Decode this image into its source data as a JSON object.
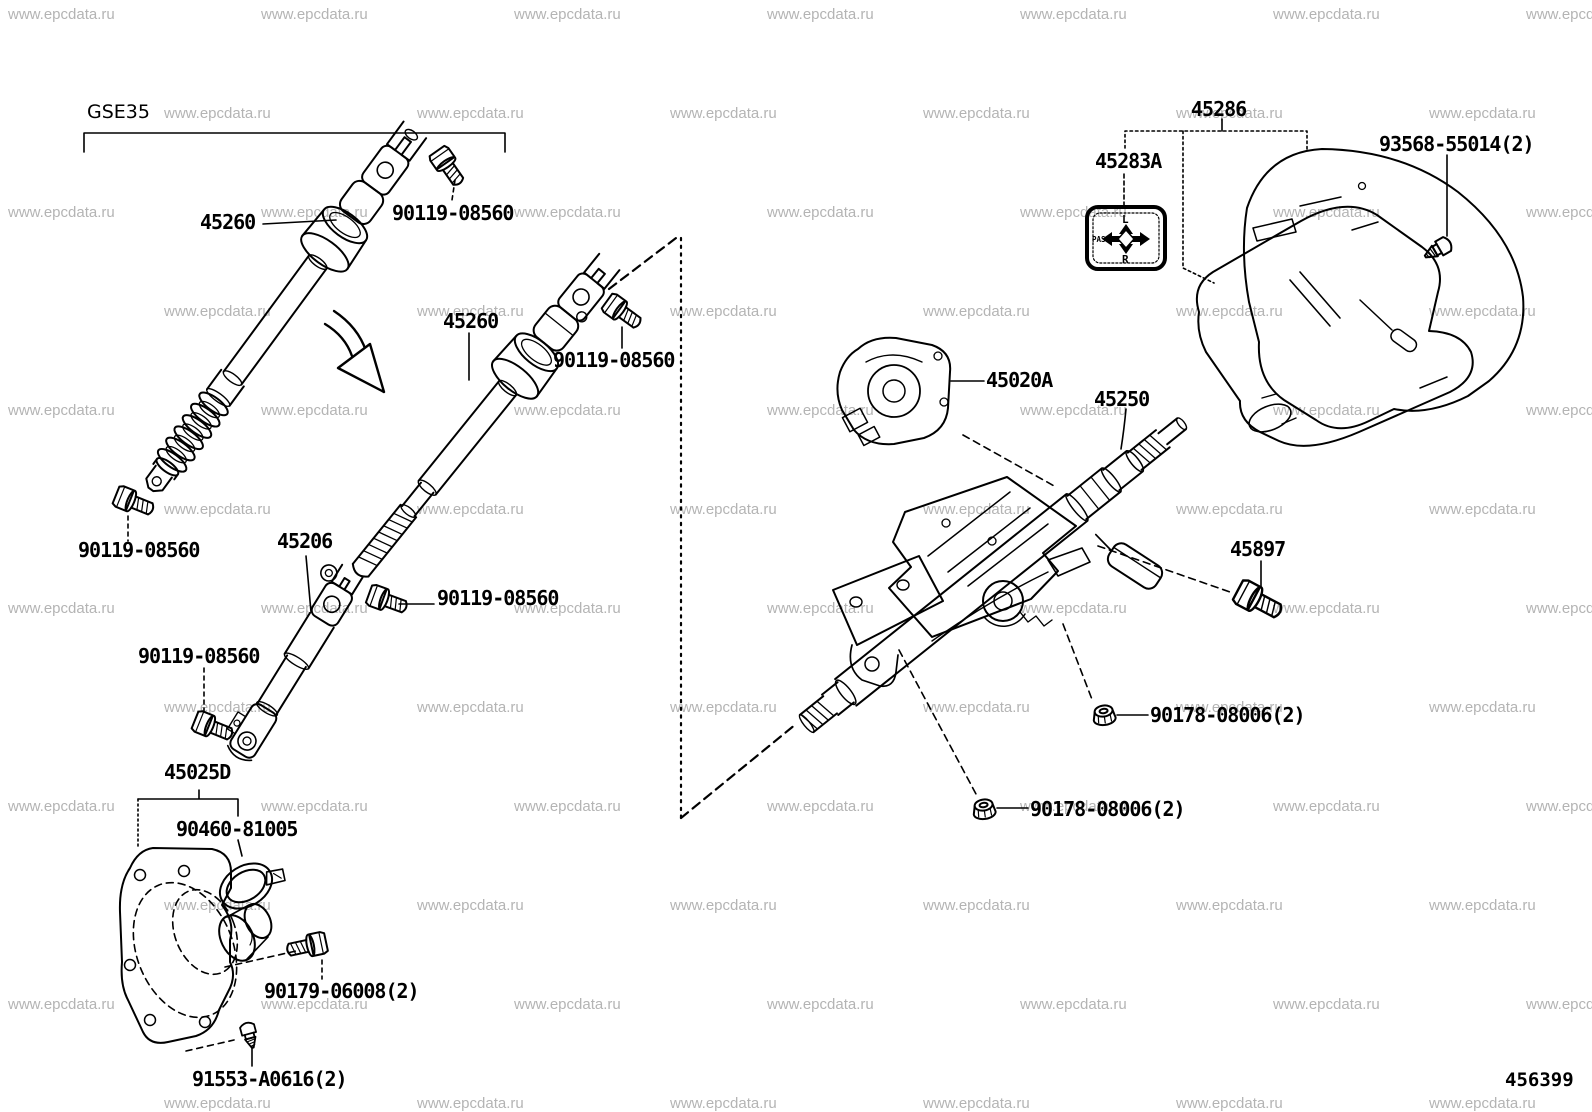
{
  "diagram": {
    "model_code": "GSE35",
    "figure_number": "456399",
    "watermark": {
      "text": "www.epcdata.ru"
    },
    "placard": {
      "top_label": "L",
      "bottom_label": "R",
      "side_label": "PASS"
    },
    "labels": [
      {
        "text": "45260"
      },
      {
        "text": "90119-08560"
      },
      {
        "text": "45260"
      },
      {
        "text": "90119-08560"
      },
      {
        "text": "45206"
      },
      {
        "text": "90119-08560"
      },
      {
        "text": "90119-08560"
      },
      {
        "text": "90119-08560"
      },
      {
        "text": "45025D"
      },
      {
        "text": "90460-81005"
      },
      {
        "text": "90179-06008(2)"
      },
      {
        "text": "91553-A0616(2)"
      },
      {
        "text": "45286"
      },
      {
        "text": "45283A"
      },
      {
        "text": "93568-55014(2)"
      },
      {
        "text": "45020A"
      },
      {
        "text": "45250"
      },
      {
        "text": "45897"
      },
      {
        "text": "90178-08006(2)"
      },
      {
        "text": "90178-08006(2)"
      }
    ]
  }
}
